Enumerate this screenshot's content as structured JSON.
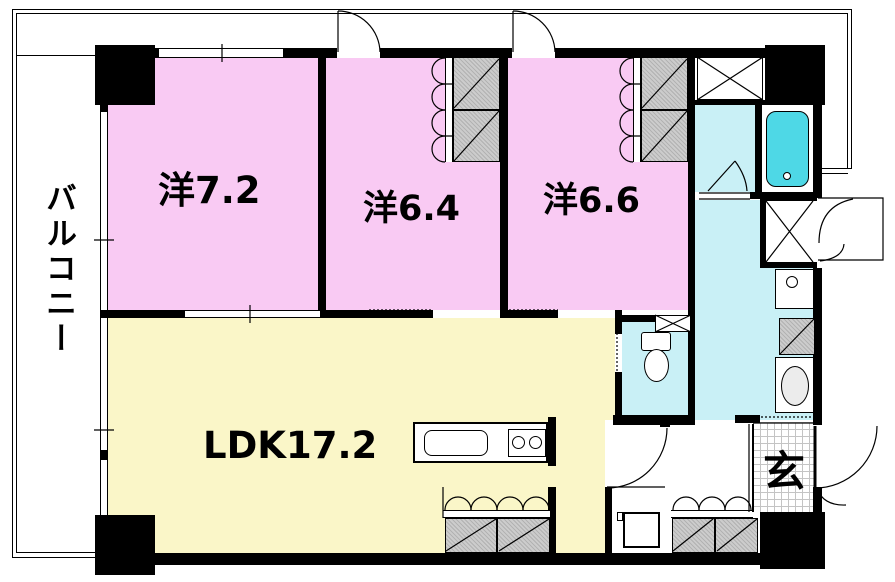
{
  "plan_title": "apartment-floor-plan",
  "rooms": {
    "balcony": {
      "label": "バルコニー"
    },
    "western1": {
      "label": "洋7.2"
    },
    "western2": {
      "label": "洋6.4"
    },
    "western3": {
      "label": "洋6.6"
    },
    "ldk": {
      "label": "LDK17.2"
    },
    "entrance": {
      "label": "玄"
    }
  },
  "colors": {
    "bedroom": "#F9CAF3",
    "ldk": "#FAF6C8",
    "wet_area": "#C9F0F6",
    "bathtub": "#4ED8E6",
    "closet_gray": "#C6C6C6",
    "wall": "#000000"
  }
}
